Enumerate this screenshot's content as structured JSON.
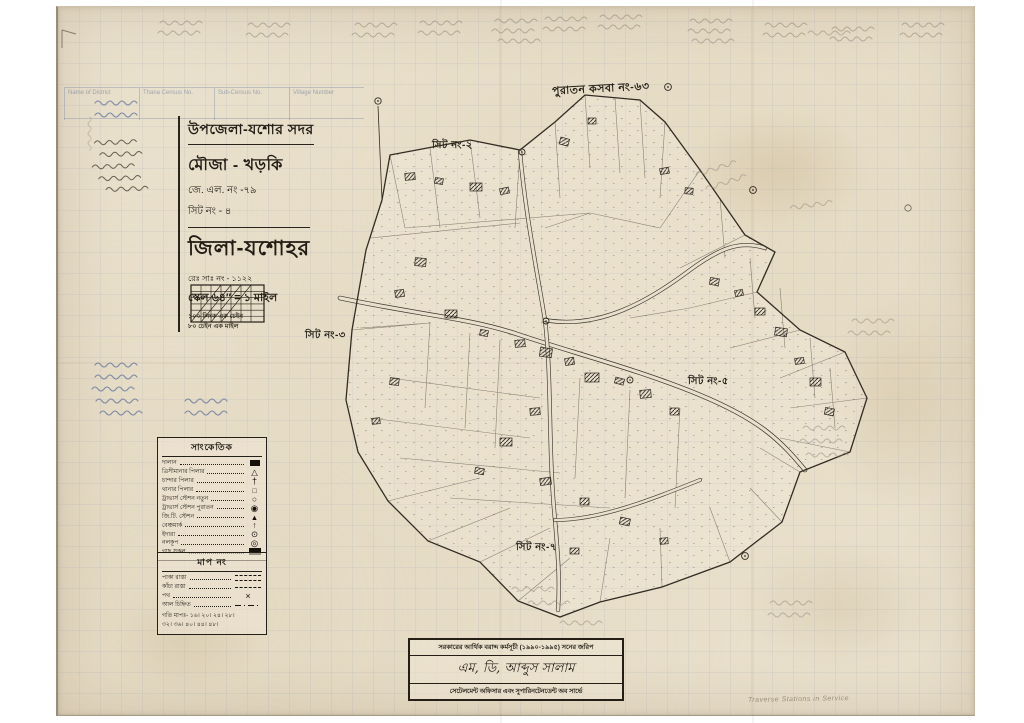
{
  "title_block": {
    "upazila": "উপজেলা-যশোর সদর",
    "mouza": "মৌজা - খড়কি",
    "jl_no": "জে. এল. নং -৭৯",
    "sheet_no": "সিট নং - ৪",
    "district": "জিলা-যশোহর",
    "survey_no": "রেঃ সাঃ নং - ১১২২",
    "scale": "স্কেল ৬৪″ = ১ মাইল",
    "scale_note1": "১০০ লিংক এক চেইন",
    "scale_note2": "৮০ চেইন এক মাইল"
  },
  "map_labels": {
    "adjacent_village": "পুরাতন কসবা নং-৬৩",
    "sheet2": "সিট নং-২",
    "sheet3": "সিট নং-৩",
    "sheet5": "সিট নং-৫",
    "sheet7": "সিট নং-৭"
  },
  "legend_symbols": {
    "header": "সাংকেতিক",
    "rows": [
      {
        "label": "দালান",
        "symbol": "building-icon"
      },
      {
        "label": "ত্রিসীমানার পিলার",
        "symbol": "triangle-pillar-icon"
      },
      {
        "label": "চান্দার পিলার",
        "symbol": "cross-pillar-icon"
      },
      {
        "label": "থানার পিলার",
        "symbol": "square-pillar-icon"
      },
      {
        "label": "ট্রাভার্স স্টেশন নতুন",
        "symbol": "traverse-new-icon"
      },
      {
        "label": "ট্রাভার্স স্টেশন পুরাতন",
        "symbol": "traverse-old-icon"
      },
      {
        "label": "জি.টি. স্টেশন",
        "symbol": "gt-station-icon"
      },
      {
        "label": "বেঞ্চমার্ক",
        "symbol": "benchmark-icon"
      },
      {
        "label": "ইদারা",
        "symbol": "well-icon"
      },
      {
        "label": "নলকূপ",
        "symbol": "tubewell-icon"
      },
      {
        "label": "গাছ সকল",
        "symbol": "trees-icon"
      }
    ]
  },
  "legend_lines": {
    "header": "মাপ নং",
    "rows": [
      {
        "label": "পাকা রাস্তা"
      },
      {
        "label": "কাঁচা রাস্তা"
      },
      {
        "label": "পথ"
      },
      {
        "label": "আল চিহ্নিত"
      }
    ],
    "scale_row1": "গতি মাপঃ- ১৬। ২০। ২৪। ২৮।",
    "scale_row2": "৩২। ৩৬। ৪০। ৪৪। ৪৮।"
  },
  "stamp": {
    "line1": "সরকারের আর্থিক বরাদ্দ কর্মসূচী (১৯৯০-১৯৯৫) সনের জরিপ",
    "line2": "এম, ডি, আব্দুস সালাম",
    "line3": "সেটেলমেন্ট অফিসার এবং সুপারিনটেনডেন্ট অব সার্ভে"
  },
  "faint_header": {
    "col1": "Name of District",
    "col2": "Thana Census No.",
    "col3": "Sub-Census No.",
    "col4": "Village Number"
  },
  "notes": {
    "pencil_en": "Traverse Stations in Service"
  },
  "colors": {
    "paper": "#e9e0cc",
    "ink": "#2a241c",
    "pencil": "#8f8474",
    "blue_ink": "#68799f",
    "grid_blue": "#9fb0c8"
  }
}
